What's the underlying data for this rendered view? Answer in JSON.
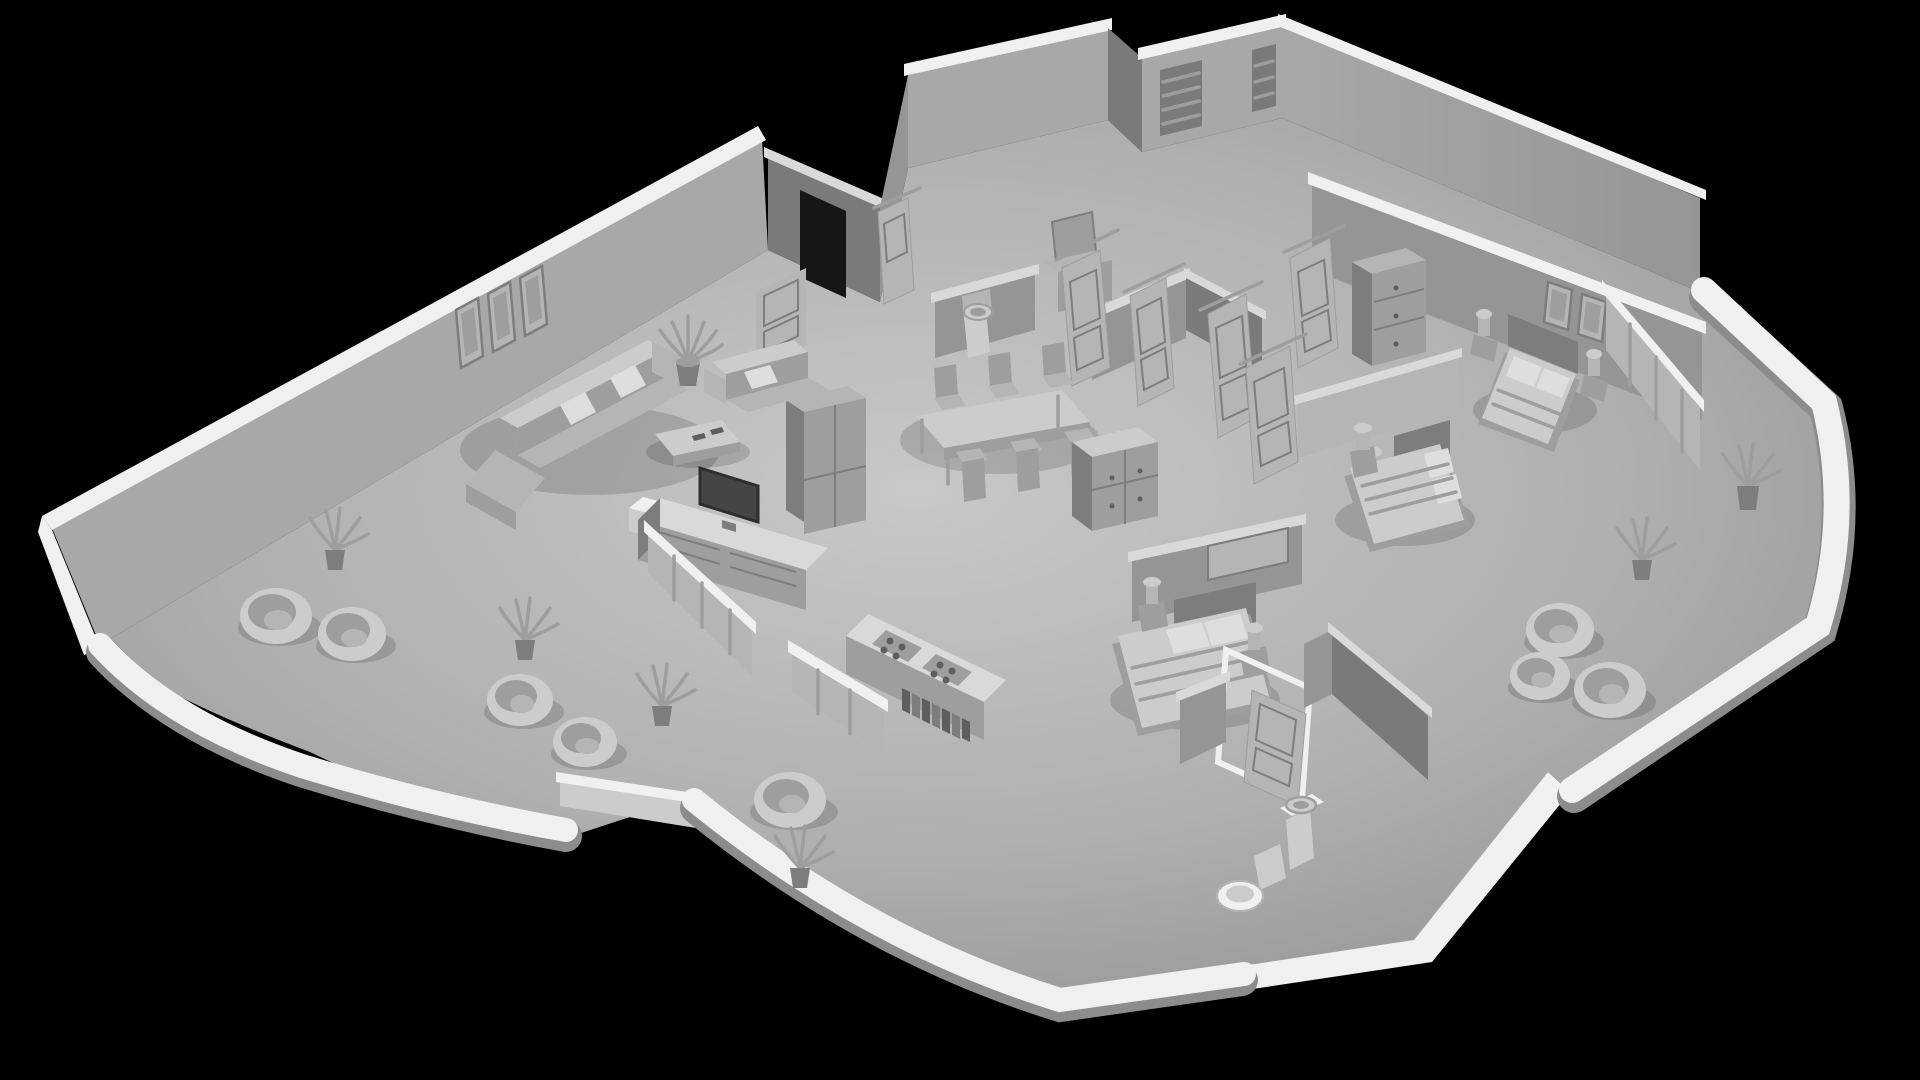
{
  "scene": {
    "title": "Grayscale 3D cutaway floor plan render of an apartment",
    "render_style": "monochrome clay / ambient-occlusion 3D render",
    "view": "elevated isometric cutaway, walls truncated, black background",
    "background_color": "#000000",
    "rooms": [
      {
        "name": "living-room",
        "furniture": [
          "sectional-sofa",
          "loveseat",
          "coffee-table",
          "tv-sideboard",
          "tv",
          "side-table-cube",
          "potted-plant",
          "wall-frames-triptych"
        ]
      },
      {
        "name": "dining-area",
        "furniture": [
          "dining-table",
          "dining-chairs-x6",
          "double-door-fridge-cabinet",
          "pedestal-washbasin",
          "low-wall"
        ]
      },
      {
        "name": "kitchen",
        "furniture": [
          "counter-with-gas-cooktops",
          "cookbook-row",
          "drawer-sideboard",
          "glass-partitions"
        ]
      },
      {
        "name": "hallway",
        "furniture": [
          "open-panel-doors-x6",
          "tall-wardrobe",
          "vanity-with-mirror",
          "storage-niche",
          "waste-bin",
          "slatted-window",
          "small-window"
        ]
      },
      {
        "name": "bedroom-master",
        "furniture": [
          "double-bed",
          "pillows-x2",
          "nightstands-x2",
          "table-lamps-x2",
          "wall-frames-x2",
          "glass-partition"
        ]
      },
      {
        "name": "bedroom-middle",
        "furniture": [
          "double-bed",
          "pillows-x2",
          "nightstand",
          "table-lamp",
          "headboard-wall",
          "low-cabinet",
          "open-door"
        ]
      },
      {
        "name": "bedroom-front",
        "furniture": [
          "double-bed",
          "pillows-x2",
          "nightstands-x2",
          "table-lamps-x2",
          "headboard-panel",
          "open-door"
        ]
      },
      {
        "name": "bathroom",
        "furniture": [
          "toilet",
          "pedestal-washbasin"
        ]
      },
      {
        "name": "balcony-left",
        "furniture": [
          "egg-chairs-x4",
          "potted-plants-x3",
          "curved-balustrade"
        ]
      },
      {
        "name": "balcony-center",
        "furniture": [
          "egg-chair",
          "potted-plant",
          "curved-balustrade"
        ]
      },
      {
        "name": "balcony-right",
        "furniture": [
          "egg-chairs-x3",
          "potted-plants-x2",
          "curved-balustrade"
        ]
      }
    ]
  },
  "palette": {
    "bg": "#000000",
    "floor-light": "#c8c8c8",
    "floor-mid": "#afafaf",
    "floor-dark": "#8c8c8c",
    "wall-lit": "#a8a8a8",
    "wall-mid": "#959595",
    "wall-shadow": "#7a7a7a",
    "wall-dark": "#636363",
    "cap-white": "#f0f0f0",
    "cap-shade": "#d9d9d9",
    "furn-light": "#cccccc",
    "furn-soft": "#b5b5b5",
    "furn-mid": "#9e9e9e",
    "furn-dark": "#7d7d7d",
    "furn-deep": "#5e5e5e",
    "screen": "#454545",
    "linen": "#dedede"
  }
}
